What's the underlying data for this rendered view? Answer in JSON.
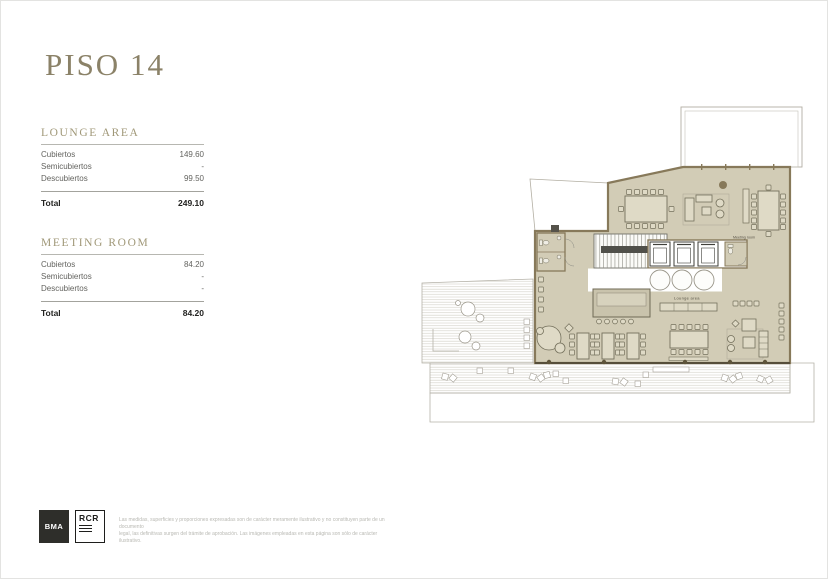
{
  "page": {
    "title": "PISO 14"
  },
  "area_tables": [
    {
      "title": "LOUNGE AREA",
      "rows": [
        {
          "label": "Cubiertos",
          "value": "149.60"
        },
        {
          "label": "Semicubiertos",
          "value": "-"
        },
        {
          "label": "Descubiertos",
          "value": "99.50"
        }
      ],
      "total_label": "Total",
      "total_value": "249.10"
    },
    {
      "title": "MEETING ROOM",
      "rows": [
        {
          "label": "Cubiertos",
          "value": "84.20"
        },
        {
          "label": "Semicubiertos",
          "value": "-"
        },
        {
          "label": "Descubiertos",
          "value": "-"
        }
      ],
      "total_label": "Total",
      "total_value": "84.20"
    }
  ],
  "floor_plan": {
    "labels": {
      "meeting_room": "Meeting room",
      "lounge_area": "Lounge area"
    },
    "colors": {
      "floor_fill": "#d2ccb6",
      "wall": "#87795a",
      "terrace_line": "#b3afa3",
      "furniture_stroke": "#74705c",
      "accent_title": "#8b8268"
    }
  },
  "footer": {
    "logo_bma": "BMA",
    "logo_rcr": "RCR",
    "disclaimer_line1": "Las medidas, superficies y proporciones expresadas son de carácter meramente ilustrativo y no constituyen parte de un documento",
    "disclaimer_line2": "legal, las definitivas surgen del trámite de aprobación. Las imágenes empleadas en esta página son sólo de carácter ilustrativo."
  }
}
